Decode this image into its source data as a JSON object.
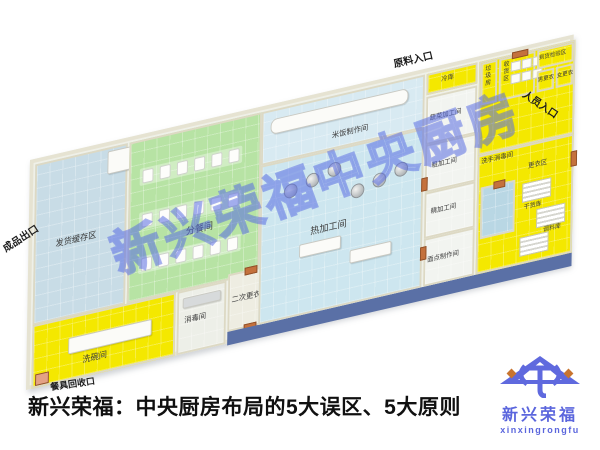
{
  "caption": "新兴荣福：中央厨房布局的5大误区、5大原则",
  "watermark": "新兴荣福中央厨房",
  "logo": {
    "name": "新兴荣福",
    "romanized": "xinxingrongfu",
    "accent_color": "#5b66dd"
  },
  "colors": {
    "floor_yellow": "#f4e800",
    "floor_green": "#b7e3a4",
    "floor_blue": "#cde6ef",
    "floor_gray_blue": "#c8dce6",
    "corridor_dark": "#5a70a6",
    "wall": "#e6e3d2",
    "door": "#c4713d"
  },
  "plan": {
    "entrances": {
      "material_entrance": "原料入口",
      "personnel_entrance": "人员入口",
      "product_exit": "成品出口",
      "dish_return": "餐具回收口"
    },
    "rooms": {
      "shipping_buffer": "发货缓存区",
      "portioning": "分餐间",
      "hot_processing": "热加工间",
      "rice_making": "米饭制作间",
      "disinfection": "消毒间",
      "second_changing": "二次更衣",
      "dishwashing": "洗碗间",
      "vegetable_processing": "蔬菜加工间",
      "rough_processing": "粗加工间",
      "fine_processing": "精加工间",
      "pastry_making": "面点制作间",
      "cold_storage": "冷库",
      "garbage_room": "垃圾房",
      "receiving": "收货区",
      "inspection": "到货检验区",
      "men_changing": "男更衣",
      "women_changing": "女更衣",
      "hand_washing": "洗手消毒间",
      "changing_area": "更衣区",
      "dry_goods_storage": "干货库",
      "seasoning_storage": "调料库"
    }
  }
}
